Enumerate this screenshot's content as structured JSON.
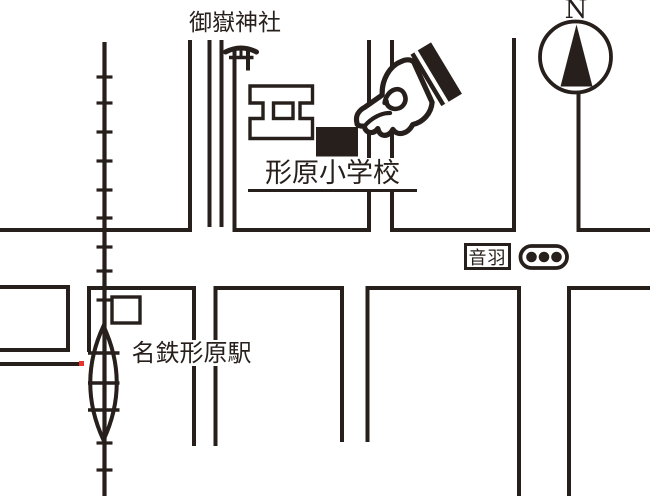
{
  "map": {
    "labels": {
      "shrine": "御嶽神社",
      "school": "形原小学校",
      "station": "名鉄形原駅",
      "intersection": "音羽",
      "north": "N"
    },
    "icons": {
      "shrine_symbol": "torii-icon",
      "pointer": "pointing-hand-icon",
      "compass": "compass-north-icon",
      "traffic_signal": "traffic-light-icon",
      "station_symbol": "station-oval-icon",
      "railway": "railway-line-with-ticks",
      "destination_marker": "black-building-marker",
      "school_building": "school-building-outline"
    },
    "colors": {
      "ink": "#271f1b",
      "background": "#ffffff",
      "red_marker": "#e8342a"
    }
  }
}
